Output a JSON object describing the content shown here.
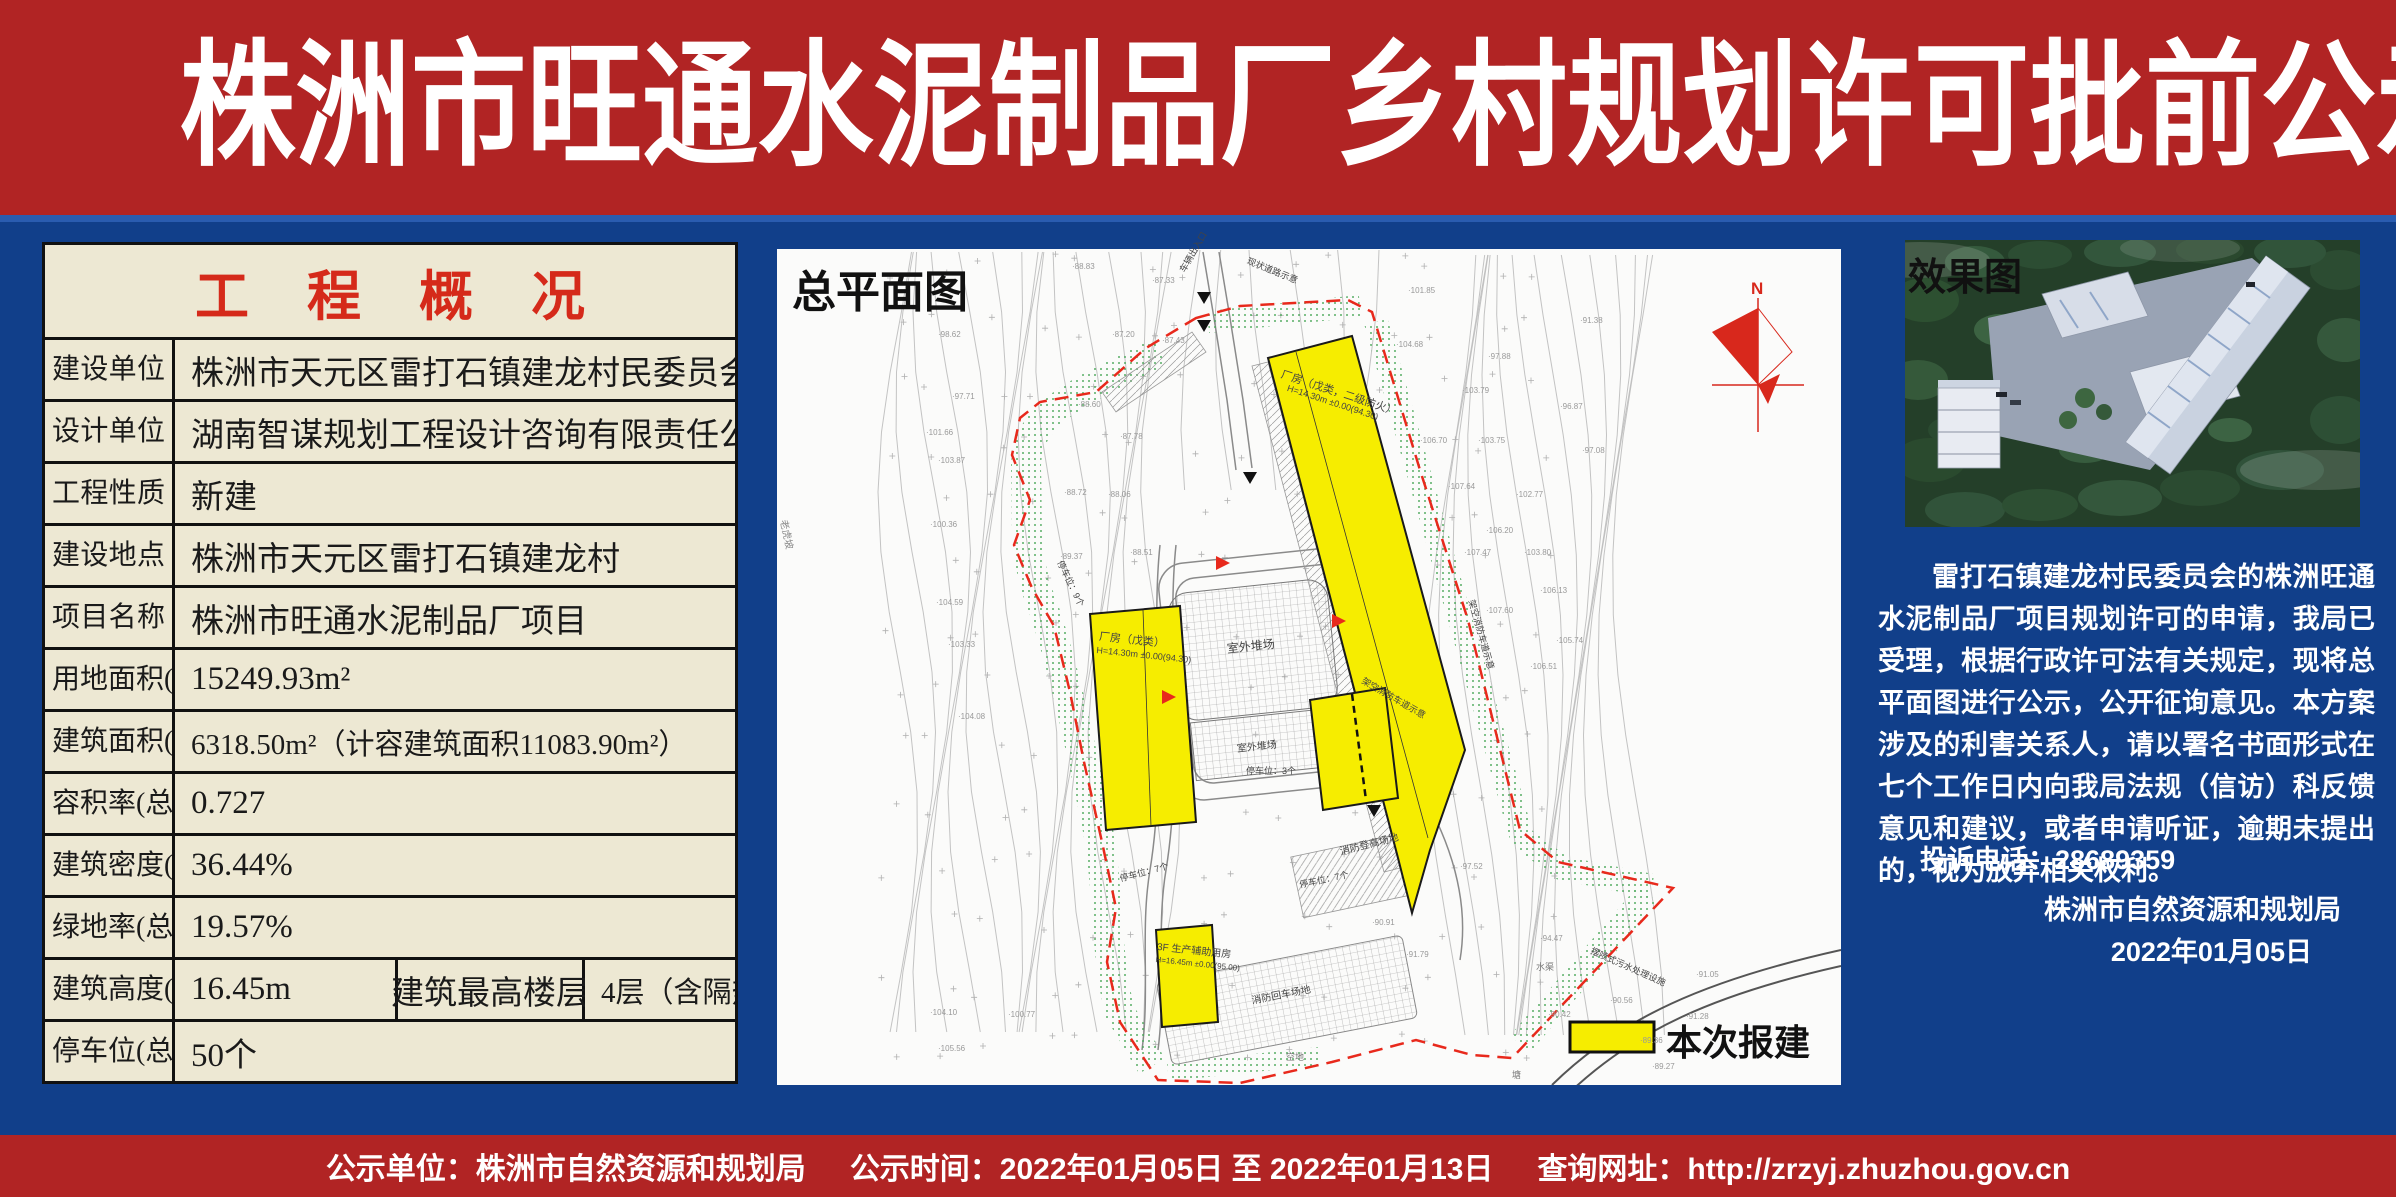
{
  "colors": {
    "banner_red": "#b12424",
    "body_blue": "#113f8a",
    "table_cream": "#ede8d3",
    "title_red": "#d52a1a",
    "building_yellow": "#f6ed00",
    "boundary_red": "#e8291c"
  },
  "header": {
    "title": "株洲市旺通水泥制品厂乡村规划许可批前公示"
  },
  "overview": {
    "title": "工程概况",
    "rows": [
      {
        "label": "建设单位",
        "value": "株洲市天元区雷打石镇建龙村民委员会"
      },
      {
        "label": "设计单位",
        "value": "湖南智谋规划工程设计咨询有限责任公司"
      },
      {
        "label": "工程性质",
        "value": "新建"
      },
      {
        "label": "建设地点",
        "value": "株洲市天元区雷打石镇建龙村"
      },
      {
        "label": "项目名称",
        "value": "株洲市旺通水泥制品厂项目"
      },
      {
        "label": "用地面积(总)",
        "value": "15249.93m²"
      },
      {
        "label": "建筑面积(总)",
        "value": "6318.50m²（计容建筑面积11083.90m²）"
      },
      {
        "label": "容积率(总)",
        "value": "0.727"
      },
      {
        "label": "建筑密度(总)",
        "value": "36.44%"
      },
      {
        "label": "绿地率(总)",
        "value": "19.57%"
      }
    ],
    "height_row": {
      "label": "建筑高度(总)",
      "value": "16.45m",
      "sub_label": "建筑最高楼层",
      "sub_value": "4层（含隔热层）"
    },
    "parking_row": {
      "label": "停车位(总)",
      "value": "50个"
    }
  },
  "plan": {
    "title": "总平面图",
    "north": "N",
    "legend_label": "本次报建",
    "annotations": [
      {
        "t": "厂房（戊类，二级防火）",
        "x": 1284,
        "y": 366,
        "r": 18,
        "s": 11
      },
      {
        "t": "H=14.30m ±0.00(94.30)",
        "x": 1289,
        "y": 383,
        "r": 18,
        "s": 9
      },
      {
        "t": "厂房（戊类）",
        "x": 1100,
        "y": 628,
        "r": 6,
        "s": 11
      },
      {
        "t": "H=14.30m ±0.00(94.30)",
        "x": 1097,
        "y": 645,
        "r": 6,
        "s": 9
      },
      {
        "t": "3F 生产辅助用房",
        "x": 1158,
        "y": 938,
        "r": 6,
        "s": 10
      },
      {
        "t": "H=16.45m ±0.00(95.00)",
        "x": 1156,
        "y": 955,
        "r": 6,
        "s": 8
      },
      {
        "t": "室外堆场",
        "x": 1226,
        "y": 640,
        "r": -6,
        "s": 12
      },
      {
        "t": "室外堆场",
        "x": 1236,
        "y": 740,
        "r": -6,
        "s": 10
      },
      {
        "t": "消防登高场地",
        "x": 1338,
        "y": 843,
        "r": -14,
        "s": 10
      },
      {
        "t": "消防回车场地",
        "x": 1250,
        "y": 992,
        "r": -11,
        "s": 10
      },
      {
        "t": "停车位：9个",
        "x": 1066,
        "y": 558,
        "r": 64,
        "s": 9
      },
      {
        "t": "停车位：3个",
        "x": 1246,
        "y": 764,
        "r": 0,
        "s": 9
      },
      {
        "t": "停车位：7个",
        "x": 1118,
        "y": 872,
        "r": -15,
        "s": 9
      },
      {
        "t": "停车位：7个",
        "x": 1298,
        "y": 878,
        "r": -12,
        "s": 9
      },
      {
        "t": "车辆出入口",
        "x": 1176,
        "y": 268,
        "r": -60,
        "s": 9
      },
      {
        "t": "现状道路示意",
        "x": 1250,
        "y": 254,
        "r": 22,
        "s": 9
      },
      {
        "t": "架空消防车道示意",
        "x": 1478,
        "y": 598,
        "r": 74,
        "s": 9
      },
      {
        "t": "架空消防车道示意",
        "x": 1366,
        "y": 674,
        "r": 30,
        "s": 9
      },
      {
        "t": "摆喷式污水处理设施",
        "x": 1594,
        "y": 944,
        "r": 24,
        "s": 9
      },
      {
        "t": "老虎坡",
        "x": 792,
        "y": 518,
        "r": 78,
        "s": 10,
        "c": "#8a8a8a"
      },
      {
        "t": "空地",
        "x": 1286,
        "y": 1050,
        "r": 0,
        "s": 9,
        "c": "#777"
      },
      {
        "t": "水渠",
        "x": 1536,
        "y": 960,
        "r": 0,
        "s": 9,
        "c": "#777"
      },
      {
        "t": "塘",
        "x": 1512,
        "y": 1068,
        "r": 0,
        "s": 9,
        "c": "#777"
      },
      {
        "t": "·88.83",
        "x": 1072,
        "y": 262,
        "s": 8,
        "c": "#999"
      },
      {
        "t": "·87.33",
        "x": 1152,
        "y": 276,
        "s": 8,
        "c": "#999"
      },
      {
        "t": "·98.62",
        "x": 938,
        "y": 330,
        "s": 8,
        "c": "#999"
      },
      {
        "t": "·87.20",
        "x": 1112,
        "y": 330,
        "s": 8,
        "c": "#999"
      },
      {
        "t": "·87.43",
        "x": 1162,
        "y": 336,
        "s": 8,
        "c": "#999"
      },
      {
        "t": "·97.71",
        "x": 952,
        "y": 392,
        "s": 8,
        "c": "#999"
      },
      {
        "t": "·88.60",
        "x": 1078,
        "y": 400,
        "s": 8,
        "c": "#999"
      },
      {
        "t": "·101.66",
        "x": 926,
        "y": 428,
        "s": 8,
        "c": "#999"
      },
      {
        "t": "·87.78",
        "x": 1120,
        "y": 432,
        "s": 8,
        "c": "#999"
      },
      {
        "t": "·103.87",
        "x": 938,
        "y": 456,
        "s": 8,
        "c": "#999"
      },
      {
        "t": "·88.72",
        "x": 1064,
        "y": 488,
        "s": 8,
        "c": "#999"
      },
      {
        "t": "·88.06",
        "x": 1108,
        "y": 490,
        "s": 8,
        "c": "#999"
      },
      {
        "t": "·100.36",
        "x": 930,
        "y": 520,
        "s": 8,
        "c": "#999"
      },
      {
        "t": "·89.37",
        "x": 1060,
        "y": 552,
        "s": 8,
        "c": "#999"
      },
      {
        "t": "·88.51",
        "x": 1130,
        "y": 548,
        "s": 8,
        "c": "#999"
      },
      {
        "t": "·104.59",
        "x": 936,
        "y": 598,
        "s": 8,
        "c": "#999"
      },
      {
        "t": "·103.33",
        "x": 948,
        "y": 640,
        "s": 8,
        "c": "#999"
      },
      {
        "t": "·104.08",
        "x": 958,
        "y": 712,
        "s": 8,
        "c": "#999"
      },
      {
        "t": "·104.10",
        "x": 930,
        "y": 1008,
        "s": 8,
        "c": "#999"
      },
      {
        "t": "·105.56",
        "x": 938,
        "y": 1044,
        "s": 8,
        "c": "#999"
      },
      {
        "t": "·100.77",
        "x": 1008,
        "y": 1010,
        "s": 8,
        "c": "#999"
      },
      {
        "t": "·101.85",
        "x": 1408,
        "y": 286,
        "s": 8,
        "c": "#999"
      },
      {
        "t": "·104.68",
        "x": 1396,
        "y": 340,
        "s": 8,
        "c": "#999"
      },
      {
        "t": "·91.38",
        "x": 1580,
        "y": 316,
        "s": 8,
        "c": "#999"
      },
      {
        "t": "·97.88",
        "x": 1488,
        "y": 352,
        "s": 8,
        "c": "#999"
      },
      {
        "t": "·103.79",
        "x": 1462,
        "y": 386,
        "s": 8,
        "c": "#999"
      },
      {
        "t": "·96.87",
        "x": 1560,
        "y": 402,
        "s": 8,
        "c": "#999"
      },
      {
        "t": "·106.70",
        "x": 1420,
        "y": 436,
        "s": 8,
        "c": "#999"
      },
      {
        "t": "·103.75",
        "x": 1478,
        "y": 436,
        "s": 8,
        "c": "#999"
      },
      {
        "t": "·97.08",
        "x": 1582,
        "y": 446,
        "s": 8,
        "c": "#999"
      },
      {
        "t": "·107.64",
        "x": 1448,
        "y": 482,
        "s": 8,
        "c": "#999"
      },
      {
        "t": "·102.77",
        "x": 1516,
        "y": 490,
        "s": 8,
        "c": "#999"
      },
      {
        "t": "·106.20",
        "x": 1486,
        "y": 526,
        "s": 8,
        "c": "#999"
      },
      {
        "t": "·107.47",
        "x": 1464,
        "y": 548,
        "s": 8,
        "c": "#999"
      },
      {
        "t": "·103.80",
        "x": 1524,
        "y": 548,
        "s": 8,
        "c": "#999"
      },
      {
        "t": "·106.13",
        "x": 1540,
        "y": 586,
        "s": 8,
        "c": "#999"
      },
      {
        "t": "·107.60",
        "x": 1486,
        "y": 606,
        "s": 8,
        "c": "#999"
      },
      {
        "t": "·105.74",
        "x": 1556,
        "y": 636,
        "s": 8,
        "c": "#999"
      },
      {
        "t": "·106.51",
        "x": 1530,
        "y": 662,
        "s": 8,
        "c": "#999"
      },
      {
        "t": "·97.52",
        "x": 1460,
        "y": 862,
        "s": 8,
        "c": "#999"
      },
      {
        "t": "·94.47",
        "x": 1540,
        "y": 934,
        "s": 8,
        "c": "#999"
      },
      {
        "t": "·90.91",
        "x": 1372,
        "y": 918,
        "s": 8,
        "c": "#999"
      },
      {
        "t": "·91.79",
        "x": 1406,
        "y": 950,
        "s": 8,
        "c": "#999"
      },
      {
        "t": "·90.42",
        "x": 1548,
        "y": 1010,
        "s": 8,
        "c": "#999"
      },
      {
        "t": "·91.05",
        "x": 1696,
        "y": 970,
        "s": 8,
        "c": "#999"
      },
      {
        "t": "·90.56",
        "x": 1610,
        "y": 996,
        "s": 8,
        "c": "#999"
      },
      {
        "t": "·91.28",
        "x": 1686,
        "y": 1012,
        "s": 8,
        "c": "#999"
      },
      {
        "t": "·89.36",
        "x": 1640,
        "y": 1036,
        "s": 8,
        "c": "#999"
      },
      {
        "t": "·89.27",
        "x": 1652,
        "y": 1062,
        "s": 8,
        "c": "#999"
      }
    ]
  },
  "render_panel": {
    "title": "效果图",
    "paragraph": "雷打石镇建龙村民委员会的株洲旺通水泥制品厂项目规划许可的申请，我局已受理，根据行政许可法有关规定，现将总平面图进行公示，公开征询意见。本方案涉及的利害关系人，请以署名书面形式在七个工作日内向我局法规（信访）科反馈意见和建议，或者申请听证，逾期未提出的，视为放弃相关权利。",
    "complaint": "投诉电话：28689359",
    "agency": "株洲市自然资源和规划局",
    "date": "2022年01月05日"
  },
  "footer": {
    "unit": "公示单位：株洲市自然资源和规划局",
    "time": "公示时间：2022年01月05日 至 2022年01月13日",
    "url": "查询网址：http://zrzyj.zhuzhou.gov.cn"
  }
}
